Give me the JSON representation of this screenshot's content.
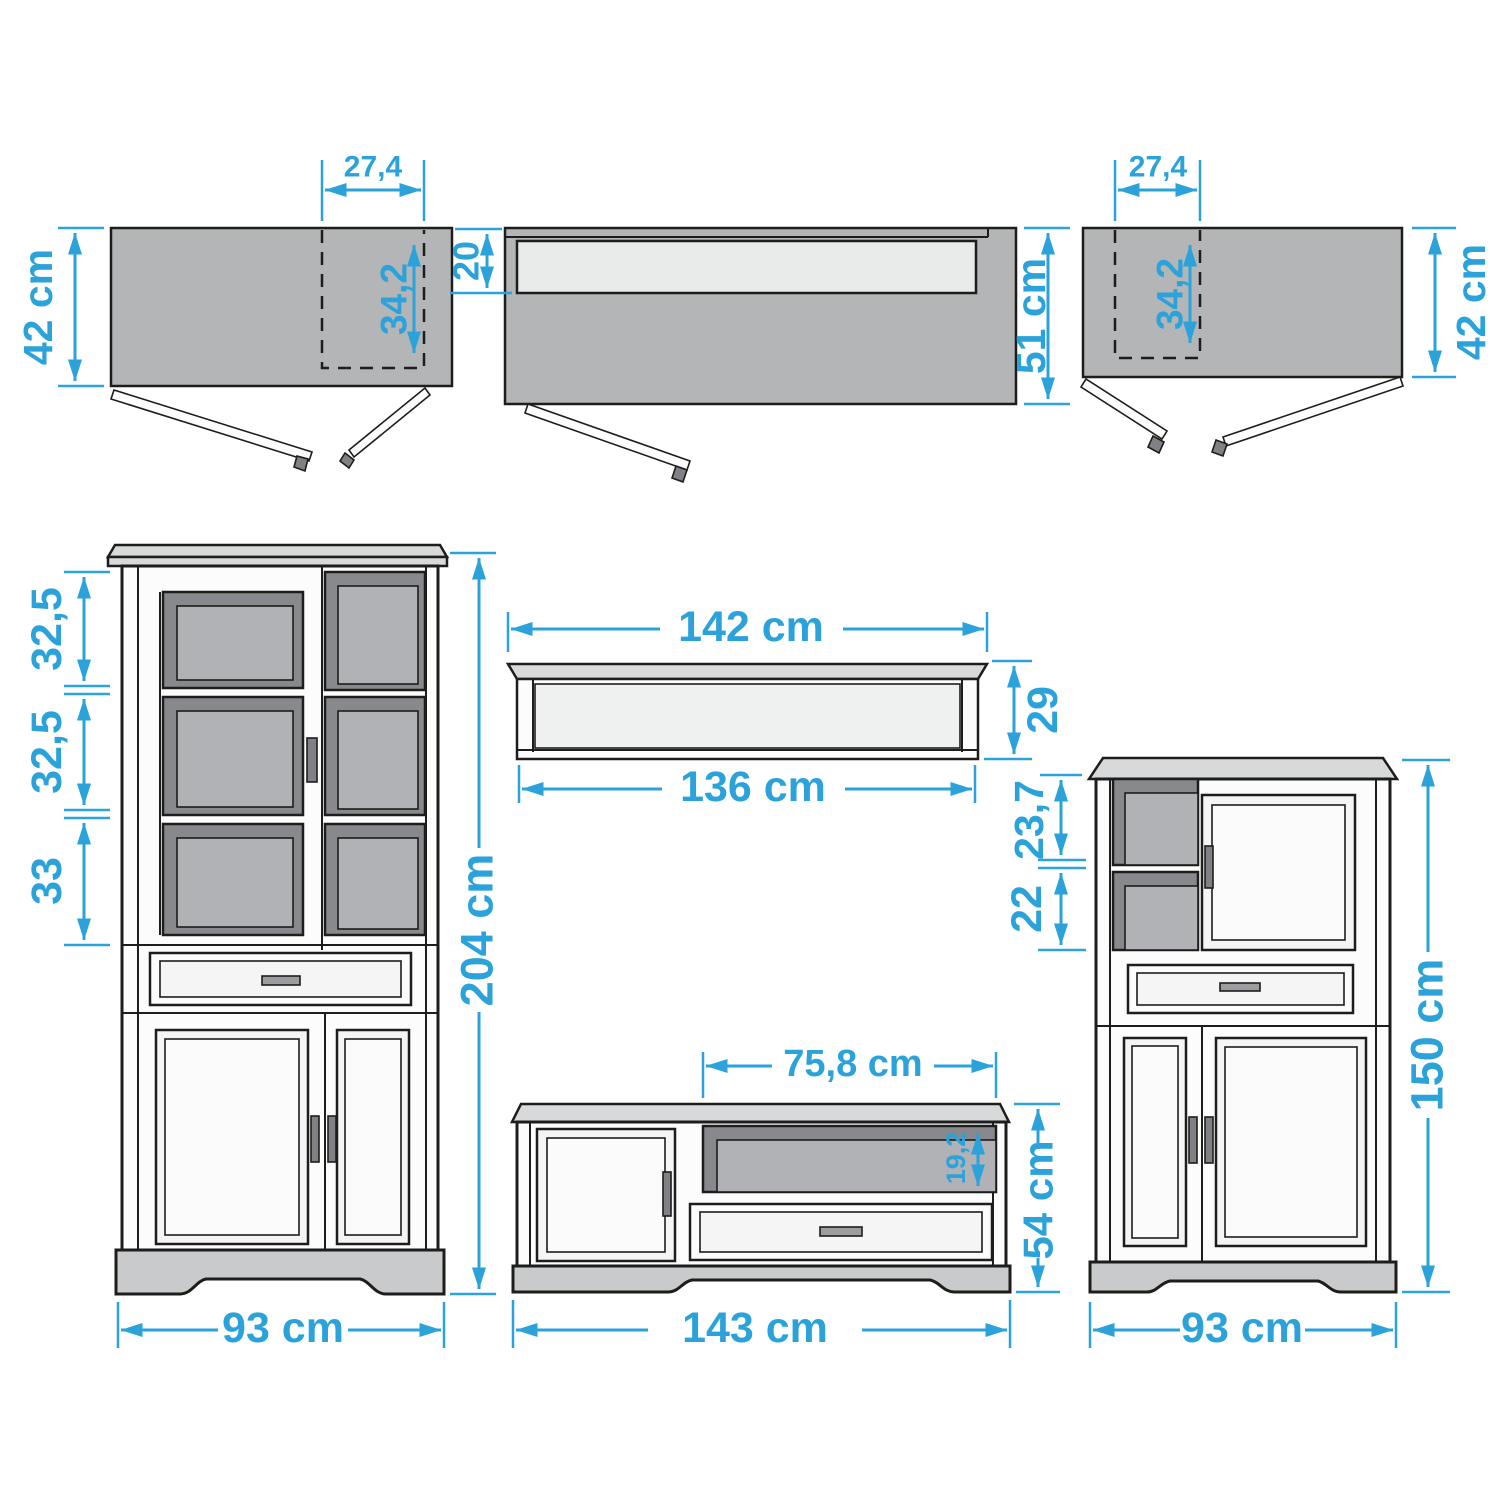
{
  "colors": {
    "accent": "#2BA3DA",
    "outline": "#1d1d1b",
    "gray_top": "#b3b5b7",
    "light_panel": "#e9eaea",
    "dark_shadow": "#87898c",
    "mid_gray": "#b0b2b5",
    "body_white": "#fcfcfd",
    "crown_gray": "#d8d9da",
    "plinth_gray": "#c9cacb",
    "handle_gray": "#7f8184"
  },
  "top_left_view": {
    "depth": "42 cm",
    "door_width": "27,4",
    "door_depth": "34,2"
  },
  "top_middle_view": {
    "top_depth": "20",
    "depth": "51 cm"
  },
  "top_right_view": {
    "door_width": "27,4",
    "door_depth": "34,2",
    "depth": "42 cm"
  },
  "display_cabinet": {
    "section_top": "32,5",
    "section_middle": "32,5",
    "section_bottom": "33",
    "height": "204 cm",
    "width": "93 cm"
  },
  "wall_shelf": {
    "outer_width": "142 cm",
    "inner_width": "136 cm",
    "height": "29"
  },
  "tv_stand": {
    "niche_width": "75,8 cm",
    "niche_height": "19,2",
    "height": "54 cm",
    "width": "143 cm"
  },
  "highboard": {
    "niche_top": "23,7",
    "niche_bottom": "22",
    "height": "150 cm",
    "width": "93 cm"
  }
}
